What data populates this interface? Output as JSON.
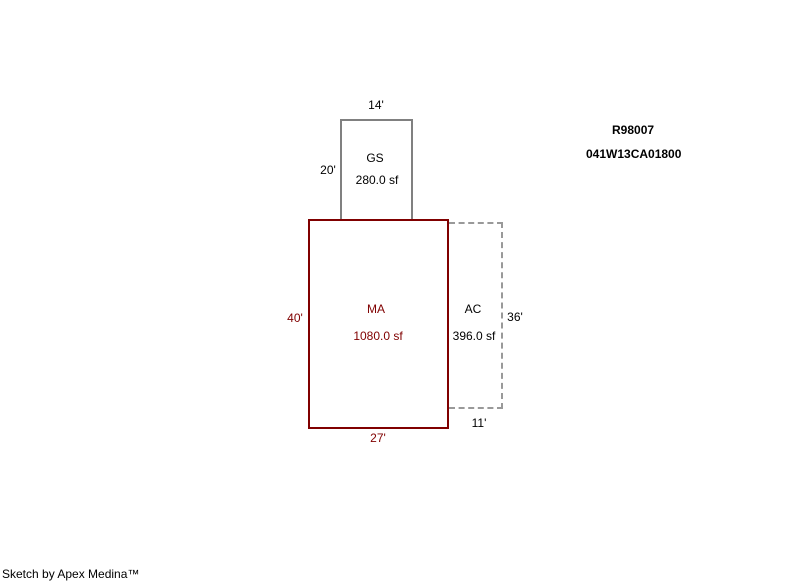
{
  "header": {
    "record_id": "R98007",
    "parcel_number": "041W13CA01800"
  },
  "footer": {
    "credit": "Sketch by Apex Medina™"
  },
  "sketch": {
    "sections": [
      {
        "code": "GS",
        "area": "280.0 sf",
        "width_label": "14'",
        "height_label": "20'",
        "outline_style": "solid",
        "outline_color": "#808080"
      },
      {
        "code": "MA",
        "area": "1080.0 sf",
        "width_label": "27'",
        "height_label": "40'",
        "outline_style": "solid",
        "outline_color": "#800000"
      },
      {
        "code": "AC",
        "area": "396.0 sf",
        "width_label": "11'",
        "height_label": "36'",
        "outline_style": "dashed",
        "outline_color": "#999999"
      }
    ],
    "colors": {
      "background": "#ffffff",
      "main_outline": "#800000",
      "main_text": "#800000",
      "attached_outline": "#808080",
      "dashed_outline": "#999999",
      "default_text": "#000000"
    }
  }
}
